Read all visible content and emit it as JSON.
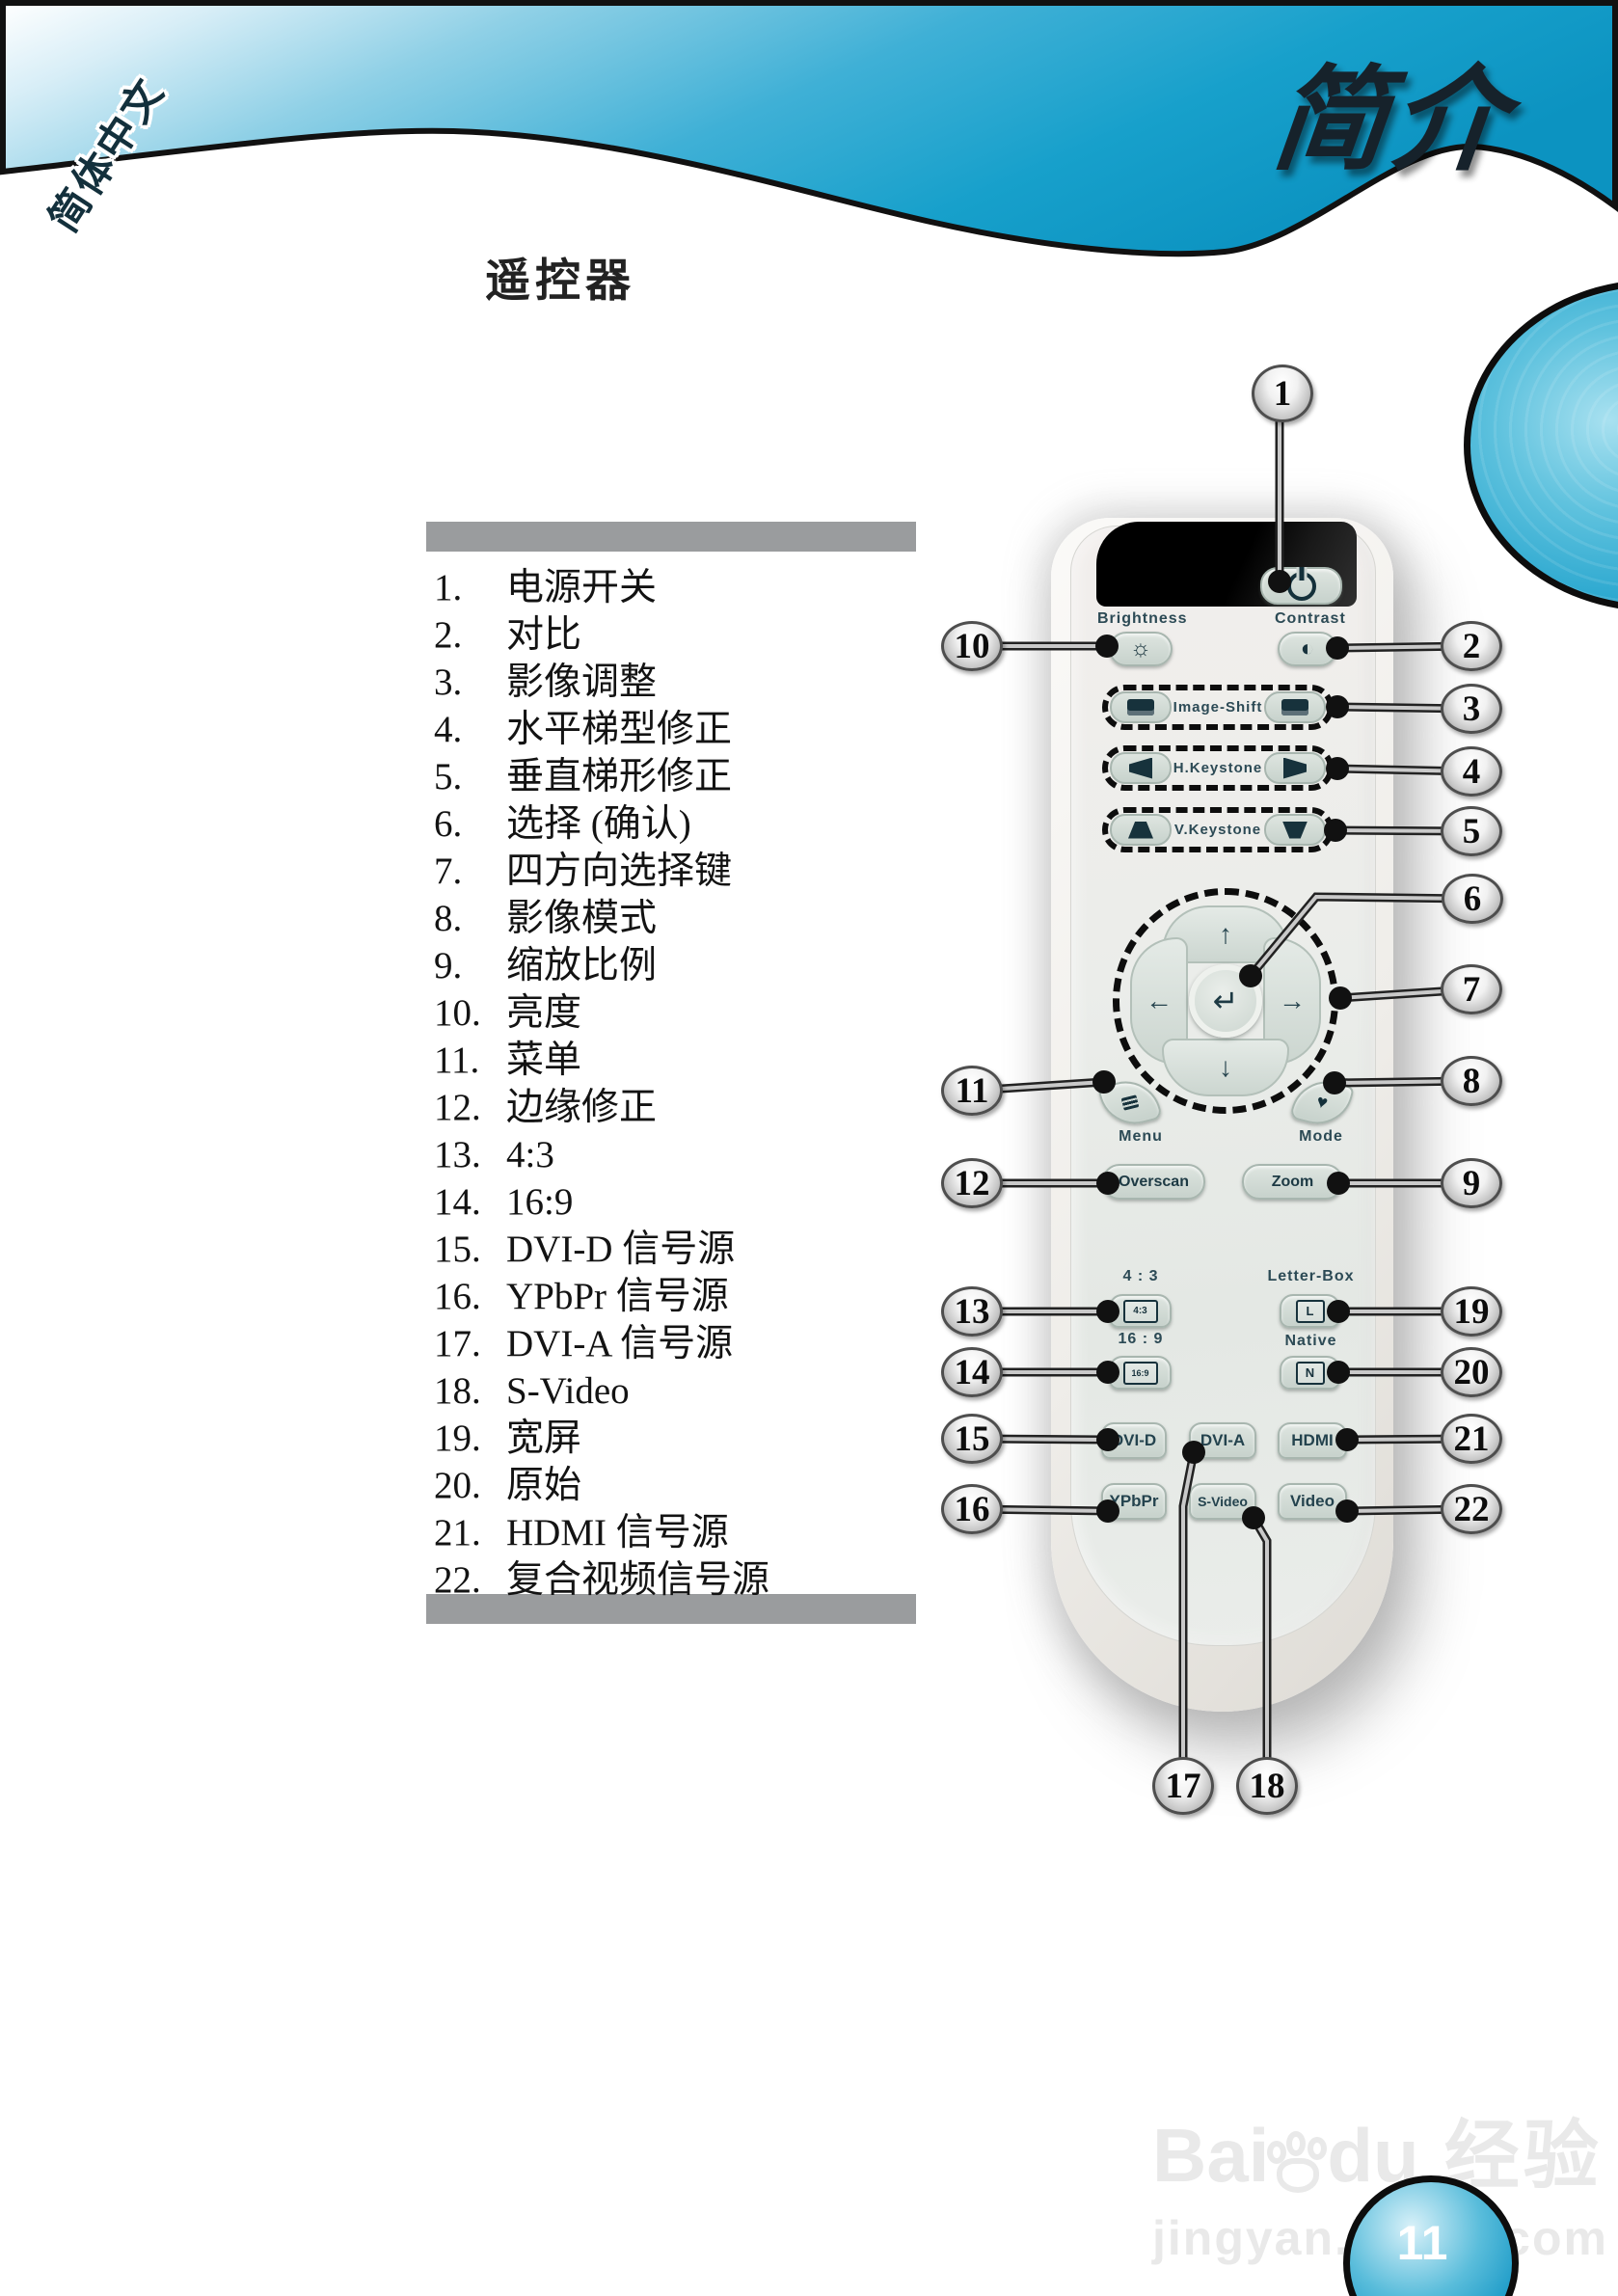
{
  "header": {
    "title": "简介",
    "side_tab": "简体中文"
  },
  "page": {
    "section_title": "遥控器",
    "page_number": "11"
  },
  "list": {
    "items": [
      {
        "num": "1.",
        "text": "电源开关"
      },
      {
        "num": "2.",
        "text": "对比"
      },
      {
        "num": "3.",
        "text": "影像调整"
      },
      {
        "num": "4.",
        "text": "水平梯型修正"
      },
      {
        "num": "5.",
        "text": "垂直梯形修正"
      },
      {
        "num": "6.",
        "text": "选择 (确认)"
      },
      {
        "num": "7.",
        "text": "四方向选择键"
      },
      {
        "num": "8.",
        "text": "影像模式"
      },
      {
        "num": "9.",
        "text": "缩放比例"
      },
      {
        "num": "10.",
        "text": "亮度"
      },
      {
        "num": "11.",
        "text": "菜单"
      },
      {
        "num": "12.",
        "text": "边缘修正"
      },
      {
        "num": "13.",
        "text": "4:3"
      },
      {
        "num": "14.",
        "text": "16:9"
      },
      {
        "num": "15.",
        "text": "DVI-D 信号源"
      },
      {
        "num": "16.",
        "text": "YPbPr 信号源"
      },
      {
        "num": "17.",
        "text": "DVI-A 信号源"
      },
      {
        "num": "18.",
        "text": "S-Video"
      },
      {
        "num": "19.",
        "text": "宽屏"
      },
      {
        "num": "20.",
        "text": "原始"
      },
      {
        "num": "21.",
        "text": "HDMI 信号源"
      },
      {
        "num": "22.",
        "text": "复合视频信号源"
      }
    ]
  },
  "remote": {
    "brightness_label": "Brightness",
    "contrast_label": "Contrast",
    "image_shift_label": "Image-Shift",
    "h_keystone_label": "H.Keystone",
    "v_keystone_label": "V.Keystone",
    "menu_label": "Menu",
    "mode_label": "Mode",
    "overscan_label": "Overscan",
    "zoom_label": "Zoom",
    "ratio_43_label": "4 : 3",
    "letterbox_label": "Letter-Box",
    "ratio_169_label": "16 : 9",
    "native_label": "Native",
    "icon_43": "4:3",
    "icon_169": "16:9",
    "icon_letterbox": "L",
    "icon_native": "N",
    "dvid_label": "DVI-D",
    "dvia_label": "DVI-A",
    "hdmi_label": "HDMI",
    "ypbpr_label": "YPbPr",
    "svideo_label": "S-Video",
    "video_label": "Video",
    "arrow_up": "↑",
    "arrow_down": "↓",
    "arrow_left": "←",
    "arrow_right": "→",
    "enter_glyph": "↵",
    "sun_glyph": "☼",
    "contrast_glyph": "◐",
    "mode_glyph": "♥"
  },
  "callouts": {
    "labels": [
      "1",
      "2",
      "3",
      "4",
      "5",
      "6",
      "7",
      "8",
      "9",
      "10",
      "11",
      "12",
      "13",
      "14",
      "15",
      "16",
      "17",
      "18",
      "19",
      "20",
      "21",
      "22"
    ]
  },
  "watermark": {
    "logo_bai": "Bai",
    "logo_du": "du",
    "logo_suffix": "经验",
    "url": "jingyan.baidu.com"
  }
}
